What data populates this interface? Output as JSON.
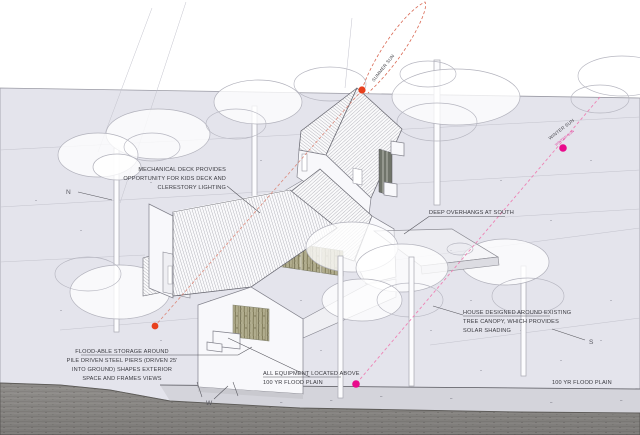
{
  "diagram": {
    "compass": {
      "north": "N",
      "west": "W",
      "south": "S"
    },
    "sun": {
      "summer_label": "SUMMER SUN",
      "winter_label": "WINTER SUN"
    },
    "notes": {
      "mechanical_deck": [
        "MECHANICAL DECK PROVIDES",
        "OPPORTUNITY FOR KIDS DECK AND",
        "CLERESTORY LIGHTING"
      ],
      "deep_overhangs": "DEEP OVERHANGS AT SOUTH",
      "tree_canopy": [
        "HOUSE DESIGNED AROUND EXISTING",
        "TREE CANOPY, WHICH PROVIDES",
        "SOLAR SHADING"
      ],
      "floodable_storage": [
        "FLOOD-ABLE STORAGE AROUND",
        "PILE DRIVEN STEEL PIERS (DRIVEN 25'",
        "INTO GROUND) SHAPES EXTERIOR",
        "SPACE AND FRAMES VIEWS"
      ],
      "equipment": [
        "ALL EQUIPMENT LOCATED ABOVE",
        "100 YR FLOOD PLAIN"
      ],
      "flood_plain": "100 YR FLOOD PLAIN"
    },
    "colors": {
      "site_plane": "#e4e4ec",
      "flood_band": "#d4d4db",
      "road": "#8f8d8a",
      "summer_sun_marker": "#e8401d",
      "winter_sun_marker": "#e90b8c",
      "summer_sun_line": "#d96a55",
      "winter_sun_line": "#ee82b4",
      "ink": "#3a3a40",
      "drawing_line": "#8a8a94"
    }
  }
}
